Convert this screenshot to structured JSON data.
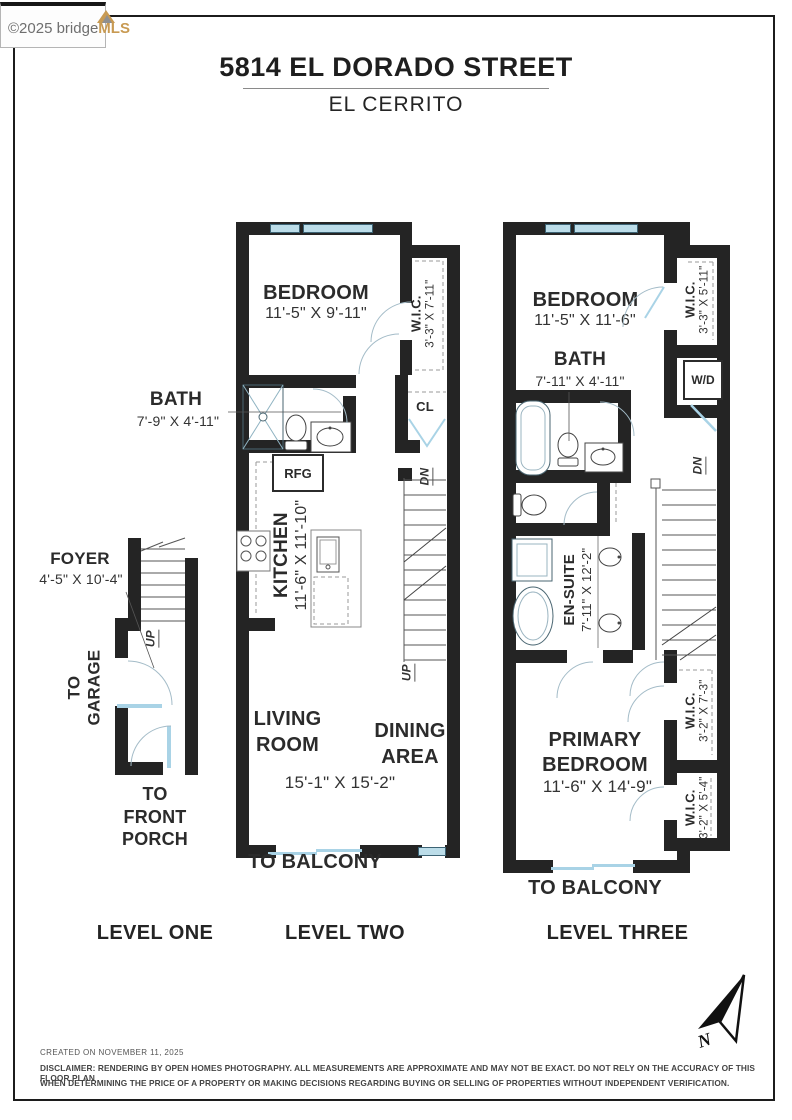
{
  "logo": {
    "copyright": "©2025 bridge",
    "brand": "MLS"
  },
  "header": {
    "title": "5814 EL DORADO STREET",
    "subtitle": "EL CERRITO"
  },
  "l1": {
    "label": "LEVEL ONE",
    "foyer": "FOYER",
    "foyer_dims": "4'-5\" X 10'-4\"",
    "to_garage_1": "TO",
    "to_garage_2": "GARAGE",
    "porch_1": "TO",
    "porch_2": "FRONT",
    "porch_3": "PORCH",
    "up": "UP"
  },
  "l2": {
    "label": "LEVEL TWO",
    "bedroom": "BEDROOM",
    "bedroom_dims": "11'-5\" X 9'-11\"",
    "wic": "W.I.C.",
    "wic_dims": "3'-3\" X 7'-11\"",
    "bath": "BATH",
    "bath_dims": "7'-9\" X 4'-11\"",
    "cl": "CL",
    "rfg": "RFG",
    "kitchen": "KITCHEN",
    "kitchen_dims": "11'-6\" X 11'-10\"",
    "dw": "D/W",
    "living_1": "LIVING",
    "living_2": "ROOM",
    "dining_1": "DINING",
    "dining_2": "AREA",
    "living_dining_dims": "15'-1\" X 15'-2\"",
    "to_balcony": "TO BALCONY",
    "dn": "DN",
    "up": "UP"
  },
  "l3": {
    "label": "LEVEL THREE",
    "bedroom": "BEDROOM",
    "bedroom_dims": "11'-5\" X 11'-6\"",
    "wic_top": "W.I.C.",
    "wic_top_dims": "3'-3\" X 5'-11\"",
    "bath": "BATH",
    "bath_dims": "7'-11\" X 4'-11\"",
    "wd": "W/D",
    "ensuite": "EN-SUITE",
    "ensuite_dims": "7'-11\" X 12'-2\"",
    "primary_1": "PRIMARY",
    "primary_2": "BEDROOM",
    "primary_dims": "11'-6\" X 14'-9\"",
    "wic_mid": "W.I.C.",
    "wic_mid_dims": "3'-2\" X 7'-3\"",
    "wic_bot": "W.I.C.",
    "wic_bot_dims": "3'-2\" X 5'-4\"",
    "to_balcony": "TO BALCONY",
    "dn": "DN"
  },
  "compass": {
    "north": "N"
  },
  "footer": {
    "created": "CREATED ON NOVEMBER 11, 2025",
    "disclaimer_1": "DISCLAIMER: RENDERING BY OPEN HOMES PHOTOGRAPHY. ALL MEASUREMENTS ARE APPROXIMATE AND MAY NOT BE EXACT. DO NOT RELY ON THE ACCURACY OF THIS FLOOR PLAN",
    "disclaimer_2": "WHEN DETERMINING THE PRICE OF A PROPERTY OR MAKING DECISIONS REGARDING BUYING OR SELLING OF PROPERTIES WITHOUT INDEPENDENT VERIFICATION."
  },
  "colors": {
    "wall": "#242424",
    "window_blue": "#bcdde9",
    "brand_gold": "#c89a52"
  }
}
